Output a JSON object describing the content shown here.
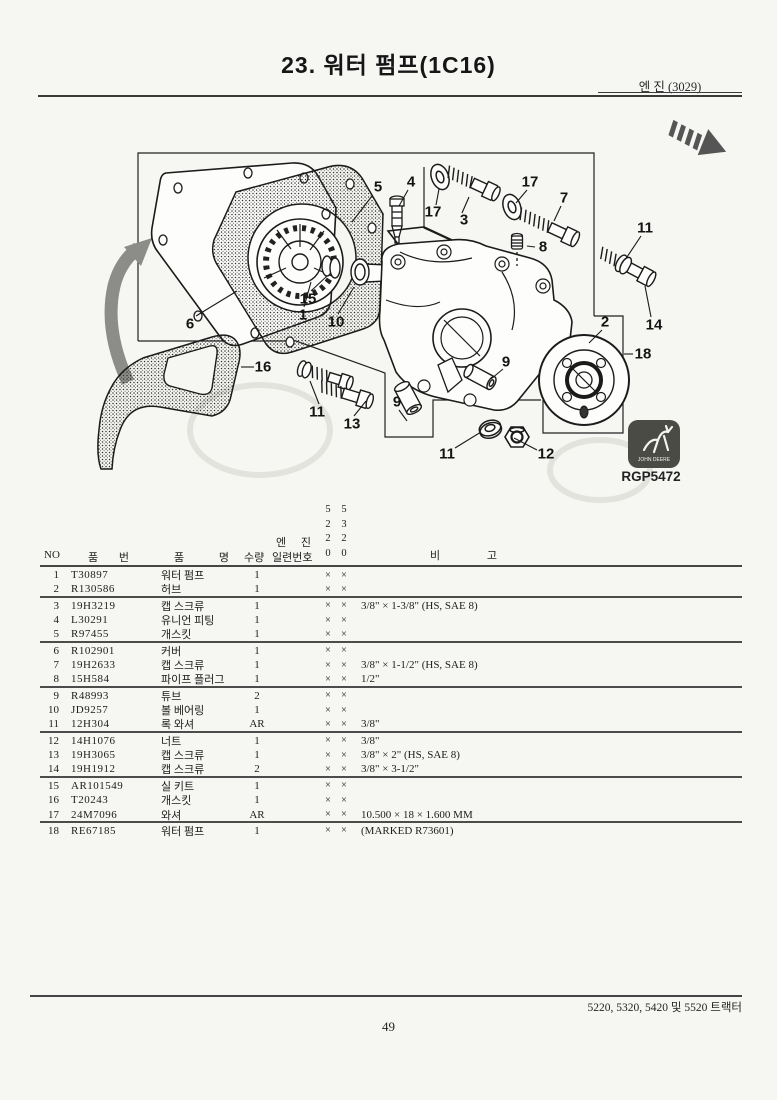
{
  "page": {
    "title": "23. 워터 펌프(1C16)",
    "engine_ref": "엔 진 (3029)",
    "figure_code": "RGP5472",
    "brand": "JOHN DEERE",
    "footer_models": "5220, 5320, 5420 및 5520 트랙터",
    "page_number": "49"
  },
  "diagram": {
    "callouts": [
      {
        "label": "5",
        "x": 378,
        "y": 187
      },
      {
        "label": "4",
        "x": 411,
        "y": 182
      },
      {
        "label": "17",
        "x": 433,
        "y": 212
      },
      {
        "label": "3",
        "x": 464,
        "y": 220
      },
      {
        "label": "17",
        "x": 530,
        "y": 182
      },
      {
        "label": "7",
        "x": 564,
        "y": 198
      },
      {
        "label": "11",
        "x": 645,
        "y": 228
      },
      {
        "label": "8",
        "x": 543,
        "y": 247
      },
      {
        "label": "14",
        "x": 654,
        "y": 325
      },
      {
        "label": "2",
        "x": 605,
        "y": 322
      },
      {
        "label": "18",
        "x": 643,
        "y": 354
      },
      {
        "label": "15",
        "x": 308,
        "y": 299
      },
      {
        "label": "1",
        "x": 303,
        "y": 315
      },
      {
        "label": "10",
        "x": 336,
        "y": 322
      },
      {
        "label": "6",
        "x": 190,
        "y": 324
      },
      {
        "label": "16",
        "x": 263,
        "y": 367
      },
      {
        "label": "11",
        "x": 317,
        "y": 412
      },
      {
        "label": "13",
        "x": 352,
        "y": 424
      },
      {
        "label": "9",
        "x": 506,
        "y": 362
      },
      {
        "label": "9",
        "x": 397,
        "y": 402
      },
      {
        "label": "11",
        "x": 447,
        "y": 454
      },
      {
        "label": "12",
        "x": 546,
        "y": 454
      }
    ]
  },
  "table": {
    "headers": {
      "no": "NO",
      "part_no": "품 번",
      "part_name": "품 명",
      "qty": "수량",
      "engine_line1": "엔 진",
      "engine_line2": "일련번호",
      "serial_cols": [
        "5220",
        "5320"
      ],
      "remarks": "비 고"
    },
    "rows": [
      {
        "no": "1",
        "part_no": "T30897",
        "name": "워터 펌프",
        "qty": "1",
        "m5220": "×",
        "m5320": "×",
        "remark": "",
        "rule_after": false
      },
      {
        "no": "2",
        "part_no": "R130586",
        "name": "허브",
        "qty": "1",
        "m5220": "×",
        "m5320": "×",
        "remark": "",
        "rule_after": true
      },
      {
        "no": "3",
        "part_no": "19H3219",
        "name": "캡 스크류",
        "qty": "1",
        "m5220": "×",
        "m5320": "×",
        "remark": "3/8\" × 1-3/8\" (HS, SAE 8)",
        "rule_after": false
      },
      {
        "no": "4",
        "part_no": "L30291",
        "name": "유니언 피팅",
        "qty": "1",
        "m5220": "×",
        "m5320": "×",
        "remark": "",
        "rule_after": false
      },
      {
        "no": "5",
        "part_no": "R97455",
        "name": "개스킷",
        "qty": "1",
        "m5220": "×",
        "m5320": "×",
        "remark": "",
        "rule_after": true
      },
      {
        "no": "6",
        "part_no": "R102901",
        "name": "커버",
        "qty": "1",
        "m5220": "×",
        "m5320": "×",
        "remark": "",
        "rule_after": false
      },
      {
        "no": "7",
        "part_no": "19H2633",
        "name": "캡 스크류",
        "qty": "1",
        "m5220": "×",
        "m5320": "×",
        "remark": "3/8\" × 1-1/2\" (HS, SAE 8)",
        "rule_after": false
      },
      {
        "no": "8",
        "part_no": "15H584",
        "name": "파이프 플러그",
        "qty": "1",
        "m5220": "×",
        "m5320": "×",
        "remark": "1/2\"",
        "rule_after": true
      },
      {
        "no": "9",
        "part_no": "R48993",
        "name": "튜브",
        "qty": "2",
        "m5220": "×",
        "m5320": "×",
        "remark": "",
        "rule_after": false
      },
      {
        "no": "10",
        "part_no": "JD9257",
        "name": "볼 베어링",
        "qty": "1",
        "m5220": "×",
        "m5320": "×",
        "remark": "",
        "rule_after": false
      },
      {
        "no": "11",
        "part_no": "12H304",
        "name": "록 와셔",
        "qty": "AR",
        "m5220": "×",
        "m5320": "×",
        "remark": "3/8\"",
        "rule_after": true
      },
      {
        "no": "12",
        "part_no": "14H1076",
        "name": "너트",
        "qty": "1",
        "m5220": "×",
        "m5320": "×",
        "remark": "3/8\"",
        "rule_after": false
      },
      {
        "no": "13",
        "part_no": "19H3065",
        "name": "캡 스크류",
        "qty": "1",
        "m5220": "×",
        "m5320": "×",
        "remark": "3/8\" × 2\" (HS, SAE 8)",
        "rule_after": false
      },
      {
        "no": "14",
        "part_no": "19H1912",
        "name": "캡 스크류",
        "qty": "2",
        "m5220": "×",
        "m5320": "×",
        "remark": "3/8\" × 3-1/2\"",
        "rule_after": true
      },
      {
        "no": "15",
        "part_no": "AR101549",
        "name": "실 키트",
        "qty": "1",
        "m5220": "×",
        "m5320": "×",
        "remark": "",
        "rule_after": false
      },
      {
        "no": "16",
        "part_no": "T20243",
        "name": "개스킷",
        "qty": "1",
        "m5220": "×",
        "m5320": "×",
        "remark": "",
        "rule_after": false
      },
      {
        "no": "17",
        "part_no": "24M7096",
        "name": "와셔",
        "qty": "AR",
        "m5220": "×",
        "m5320": "×",
        "remark": "10.500 × 18 × 1.600 MM",
        "rule_after": true
      },
      {
        "no": "18",
        "part_no": "RE67185",
        "name": "워터 펌프",
        "qty": "1",
        "m5220": "×",
        "m5320": "×",
        "remark": "(MARKED R73601)",
        "rule_after": false
      }
    ]
  }
}
